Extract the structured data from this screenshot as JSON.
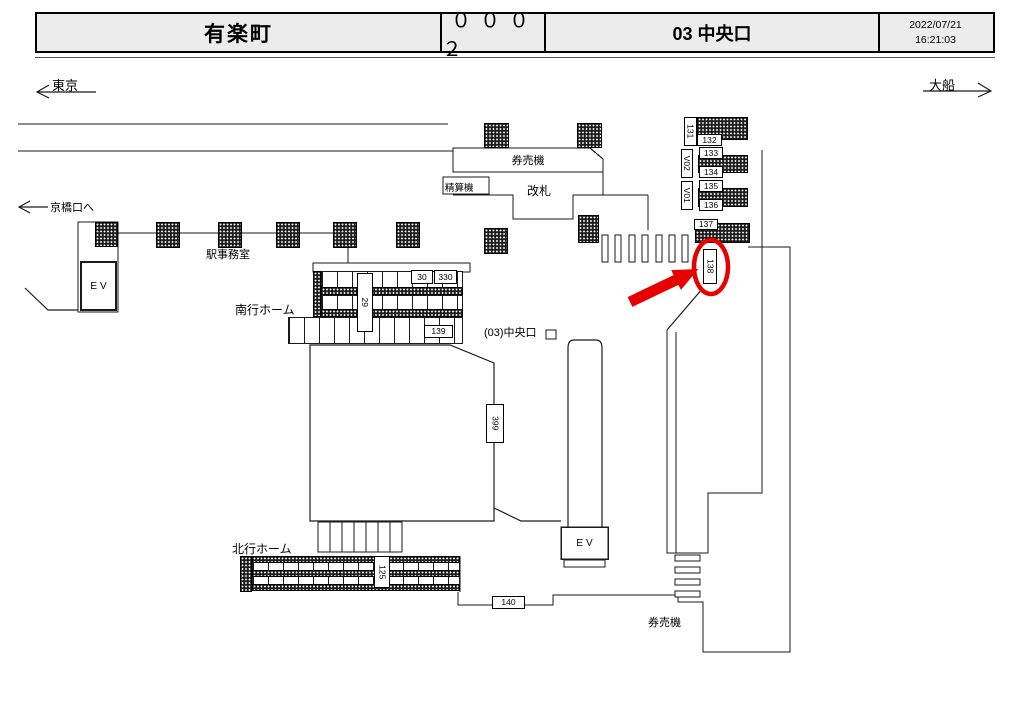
{
  "header": {
    "station": "有楽町",
    "terminal_no": "０００２",
    "location": "03 中央口",
    "date": "2022/07/21",
    "time": "16:21:03"
  },
  "directions": {
    "left_station": "東京",
    "right_station": "大船",
    "left_exit": "京橋口へ"
  },
  "facilities": {
    "ticket_machines_top": "券売機",
    "fare_adjustment_machine": "精算機",
    "ticket_gate": "改札",
    "station_office": "駅事務室",
    "southbound_platform": "南行ホーム",
    "northbound_platform": "北行ホーム",
    "central_exit": "(03)中央口",
    "ticket_machines_bottom": "券売機",
    "elevator_left": "EV",
    "elevator_center": "EV"
  },
  "position_ids": {
    "h131": "131",
    "h132": "132",
    "v02": "V02",
    "h133": "133",
    "h134": "134",
    "v01": "V01",
    "h135": "135",
    "h136": "136",
    "h137": "137",
    "h138": "138",
    "n30": "30",
    "n330": "330",
    "n29": "29",
    "n139": "139",
    "n399": "399",
    "n125": "125",
    "n140": "140"
  },
  "highlight": {
    "selected_id": "138",
    "color": "#e60000"
  },
  "colors": {
    "line": "#1a1a1a",
    "header_bg": "#ececec",
    "hatch_fill": "#1d1d1d"
  }
}
